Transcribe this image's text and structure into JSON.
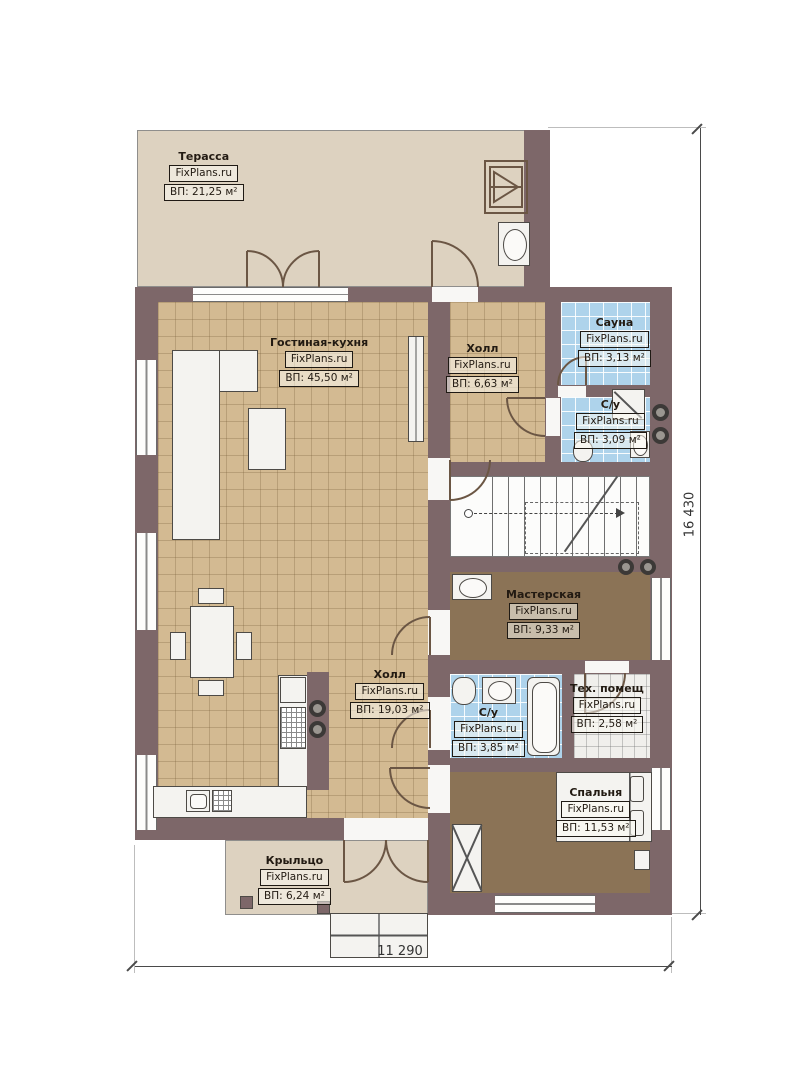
{
  "plan": {
    "title": "План первого этажа",
    "watermark": "FixPlans.ru",
    "rooms": [
      {
        "name": "Терасса",
        "area": "ВП: 21,25 м²"
      },
      {
        "name": "Гостиная-кухня",
        "area": "ВП: 45,50 м²"
      },
      {
        "name": "Холл",
        "area": "ВП: 6,63 м²"
      },
      {
        "name": "Сауна",
        "area": "ВП: 3,13 м²"
      },
      {
        "name": "С/у",
        "area": "ВП: 3,09 м²"
      },
      {
        "name": "Мастерская",
        "area": "ВП: 9,33 м²"
      },
      {
        "name": "Холл",
        "area": "ВП: 19,03 м²"
      },
      {
        "name": "С/у",
        "area": "ВП: 3,85 м²"
      },
      {
        "name": "Тех. помещ",
        "area": "ВП: 2,58 м²"
      },
      {
        "name": "Спальня",
        "area": "ВП: 11,53 м²"
      },
      {
        "name": "Крыльцо",
        "area": "ВП: 6,24 м²"
      }
    ],
    "dimensions": {
      "width": "11 290",
      "height": "16 430"
    },
    "colors": {
      "wall": "#7d6769",
      "floor_tile_tan": "#d3ba92",
      "floor_wet_blue": "#aed3eb",
      "floor_wood_brown": "#8b7356",
      "floor_terrace_beige": "#ddd2c0",
      "background": "#ffffff"
    }
  }
}
